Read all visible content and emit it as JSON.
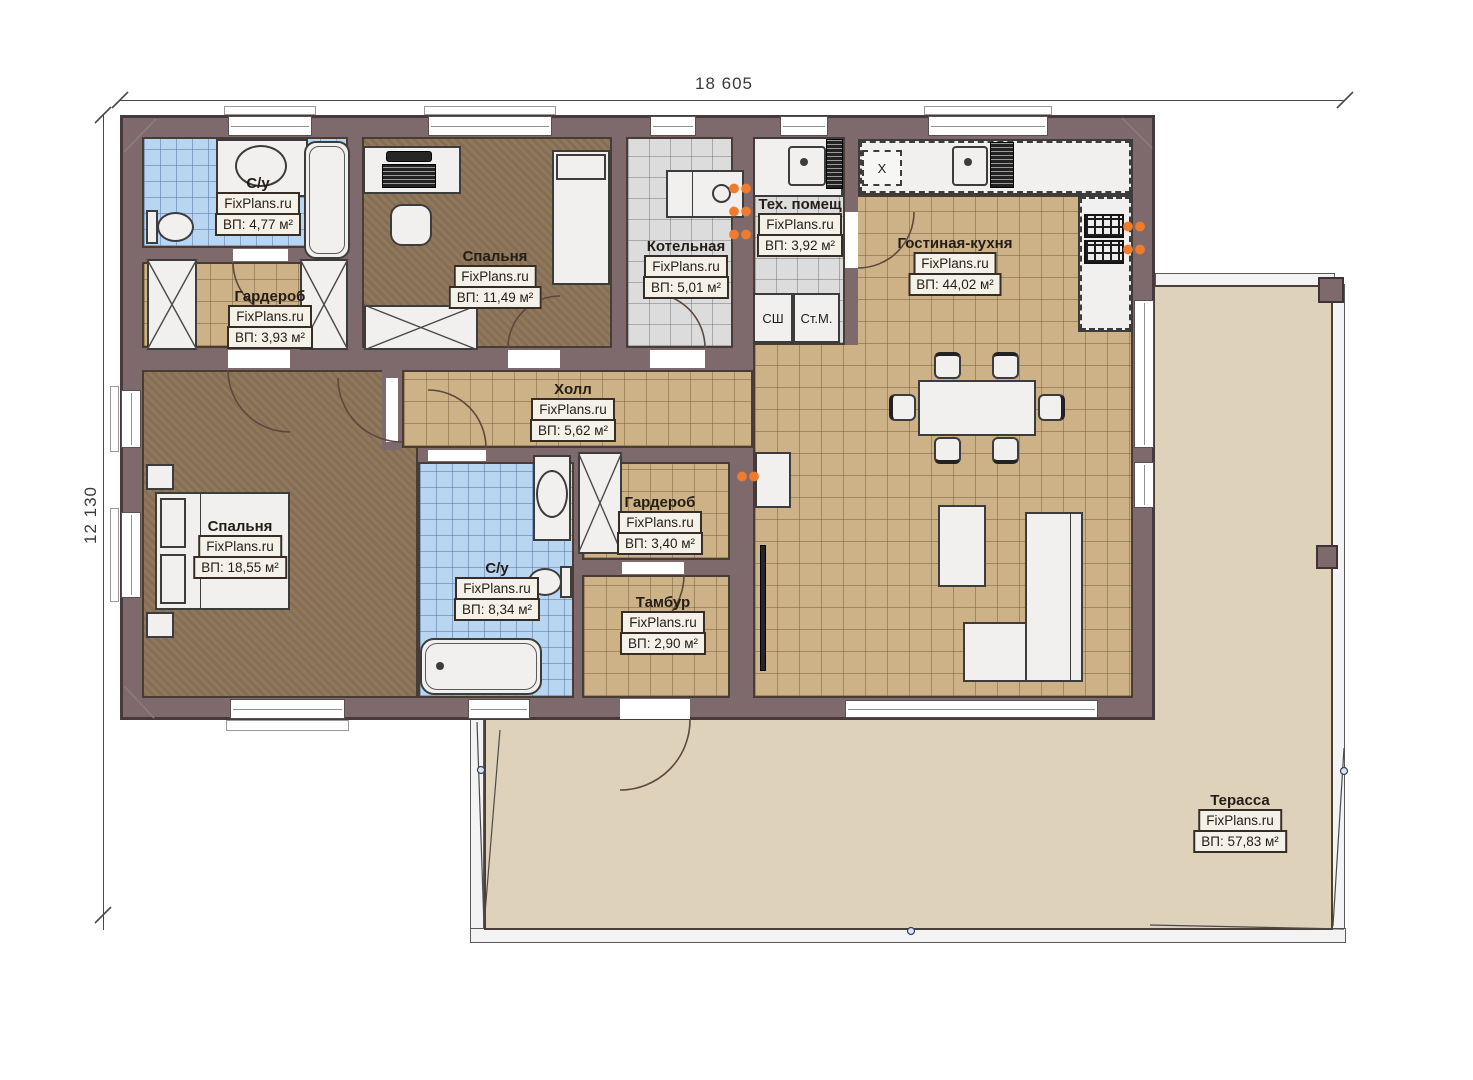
{
  "brand": "FixPlans.ru",
  "dimensions": {
    "width_label": "18 605",
    "height_label": "12 130"
  },
  "rooms": [
    {
      "id": "bath1",
      "name": "С/у",
      "area": "ВП: 4,77 м²"
    },
    {
      "id": "wardrobe1",
      "name": "Гардероб",
      "area": "ВП: 3,93 м²"
    },
    {
      "id": "bedroom1",
      "name": "Спальня",
      "area": "ВП: 11,49 м²"
    },
    {
      "id": "boiler",
      "name": "Котельная",
      "area": "ВП: 5,01 м²"
    },
    {
      "id": "tech",
      "name": "Тех. помещ",
      "area": "ВП: 3,92 м²"
    },
    {
      "id": "living",
      "name": "Гостиная-кухня",
      "area": "ВП: 44,02 м²"
    },
    {
      "id": "hall",
      "name": "Холл",
      "area": "ВП: 5,62 м²"
    },
    {
      "id": "bedroom2",
      "name": "Спальня",
      "area": "ВП: 18,55 м²"
    },
    {
      "id": "bath2",
      "name": "С/у",
      "area": "ВП: 8,34 м²"
    },
    {
      "id": "wardrobe2",
      "name": "Гардероб",
      "area": "ВП: 3,40 м²"
    },
    {
      "id": "tambour",
      "name": "Тамбур",
      "area": "ВП: 2,90 м²"
    },
    {
      "id": "terrace",
      "name": "Терасса",
      "area": "ВП: 57,83 м²"
    }
  ],
  "appliances": {
    "fridge": "Х",
    "dryer": "СШ",
    "washer": "Ст.М."
  },
  "colors": {
    "wall": "#7e6a6d",
    "tile_tan": "#cdb287",
    "tile_gray": "#dcdcdc",
    "tile_blue": "#b8d5f1",
    "floor_brown": "#8c7457",
    "terrace": "#ded2bb",
    "radiator": "#ef7c2c"
  }
}
